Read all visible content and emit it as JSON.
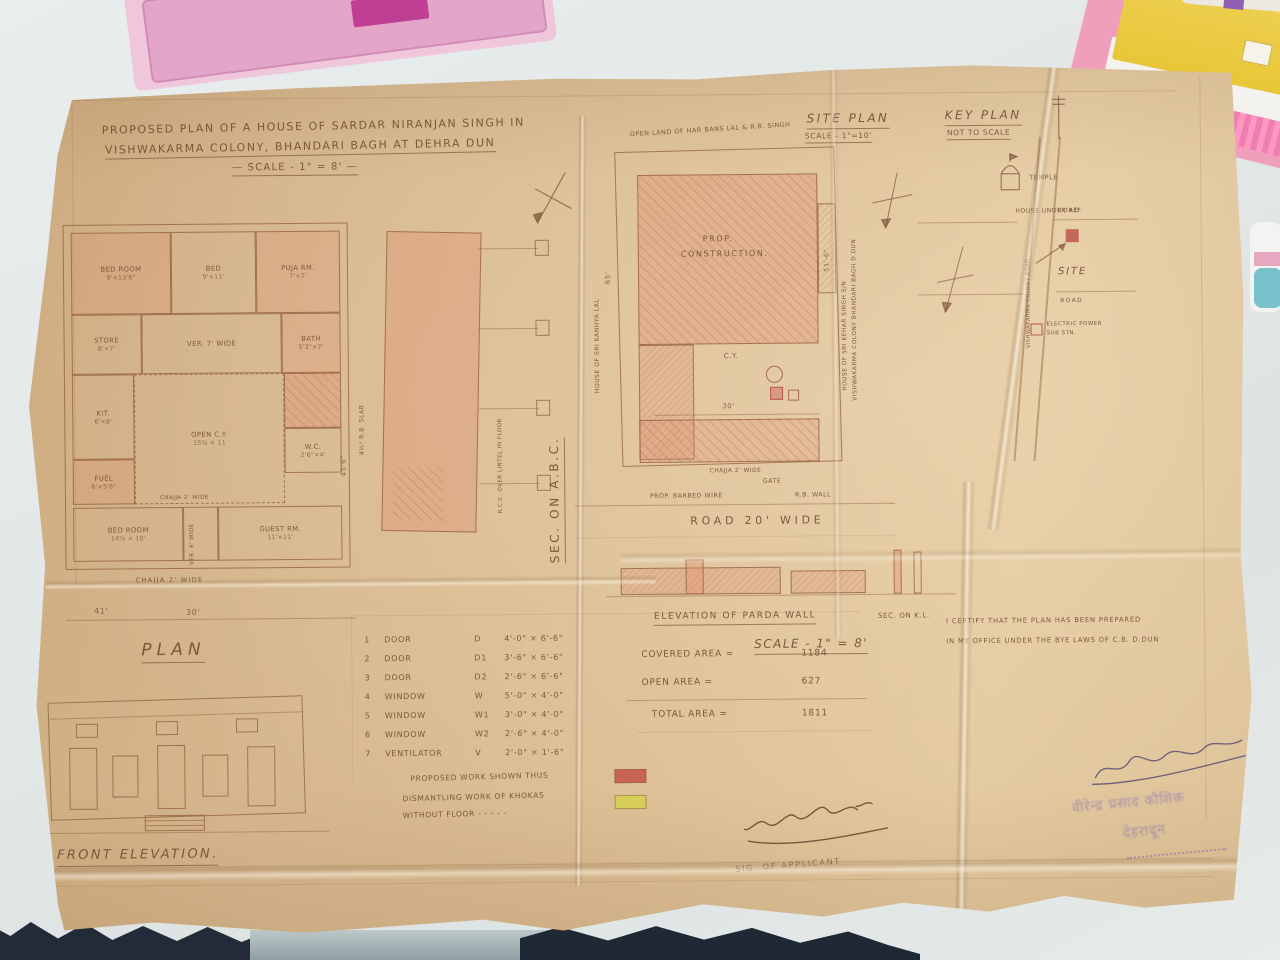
{
  "colors": {
    "paper": "#d9bd96",
    "pencil": "#8a6a4e",
    "pink_wash": "#dd8f70",
    "desk": "#e4e9e9",
    "fabric": "#232b38",
    "stamp": "#7f6cb4",
    "legend_red": "#c4524a",
    "legend_yellow": "#d6ce54",
    "site_marker_red": "#c0564b"
  },
  "title": {
    "l1": "PROPOSED PLAN OF A HOUSE OF SARDAR NIRANJAN SINGH IN",
    "l2": "VISHWAKARMA COLONY, BHANDARI BAGH AT DEHRA DUN",
    "scale": "— SCALE - 1\" = 8' —"
  },
  "floor_plan": {
    "label": "PLAN",
    "chajja_mid": "CHAJJA 2' WIDE",
    "chajja": "CHAJJA 2' WIDE",
    "dim_a": "41'",
    "dim_b": "30'",
    "rooms": [
      {
        "name": "BED ROOM",
        "size": "9'×13'6\""
      },
      {
        "name": "BED",
        "size": "9'×11'"
      },
      {
        "name": "PUJA RM.",
        "size": "7'×7'"
      },
      {
        "name": "STORE",
        "size": "8'×7'"
      },
      {
        "name": "VER. 7' WIDE",
        "size": ""
      },
      {
        "name": "BATH",
        "size": "5'3\"×7'"
      },
      {
        "name": "KIT.",
        "size": "6'×8'"
      },
      {
        "name": "OPEN C.Y.",
        "size": "15⅝ × 11"
      },
      {
        "name": "FUEL",
        "size": "6'×5'6\""
      },
      {
        "name": "W.C.",
        "size": "2'6\"×4'"
      },
      {
        "name": "BED ROOM",
        "size": "14⅝ × 10'"
      },
      {
        "name": "VER. 4' WIDE",
        "size": ""
      },
      {
        "name": "GUEST RM.",
        "size": "11'×11'"
      }
    ]
  },
  "front_elevation": {
    "label": "FRONT ELEVATION."
  },
  "section": {
    "label": "SEC. ON A.B.C.",
    "slab": "4½\" R.B. SLAB",
    "rcc": "R.C.C. OVER LINTEL IN FLOOR",
    "dim": "45'6\""
  },
  "site_plan": {
    "header": "SITE PLAN",
    "scale": "SCALE - 1\"=10'",
    "open_land": "OPEN LAND OF HAR BANS LAL & R.B. SINGH",
    "prop_l1": "PROP.",
    "prop_l2": "CONSTRUCTION.",
    "cy": "C.Y.",
    "dim_mid": "30'",
    "house_left": "HOUSE OF SRI KANHYA LAL",
    "dim_left": "65'",
    "house_right_1": "HOUSE OF SRI KEHAR SINGH S/N",
    "house_right_2": "VISHWAKARMA COLONY BHANDARI BAGH D.DUN",
    "dim_right": "51'-6\"",
    "chajja": "CHAJJA 2' WIDE",
    "gate": "GATE",
    "barbed": "PROP. BARBED WIRE",
    "wall": "R.B. WALL",
    "road": "ROAD 20' WIDE"
  },
  "key_plan": {
    "header": "KEY PLAN",
    "scale": "NOT TO SCALE",
    "temple": "TEMPLE",
    "house_ref": "HOUSE UNDER REF.",
    "road_top": "ROAD",
    "road_bottom": "ROAD",
    "road_side": "VISHWAKARMA COLONY ROAD",
    "site": "SITE",
    "power_l1": "ELECTRIC POWER",
    "power_l2": "SUB STN."
  },
  "parda": {
    "label": "ELEVATION OF PARDA WALL",
    "sec": "SEC. ON K.L.",
    "scale": "SCALE - 1\" = 8'"
  },
  "schedule": {
    "rows": [
      {
        "no": "1",
        "item": "DOOR",
        "sym": "D",
        "size": "4'-0\" × 6'-6\""
      },
      {
        "no": "2",
        "item": "DOOR",
        "sym": "D1",
        "size": "3'-6\" × 6'-6\""
      },
      {
        "no": "3",
        "item": "DOOR",
        "sym": "D2",
        "size": "2'-6\" × 6'-6\""
      },
      {
        "no": "4",
        "item": "WINDOW",
        "sym": "W",
        "size": "5'-0\" × 4'-0\""
      },
      {
        "no": "5",
        "item": "WINDOW",
        "sym": "W1",
        "size": "3'-0\" × 4'-0\""
      },
      {
        "no": "6",
        "item": "WINDOW",
        "sym": "W2",
        "size": "2'-6\" × 4'-0\""
      },
      {
        "no": "7",
        "item": "VENTILATOR",
        "sym": "V",
        "size": "2'-0\" × 1'-6\""
      }
    ]
  },
  "areas": {
    "covered_label": "COVERED AREA =",
    "covered": "1184",
    "open_label": "OPEN AREA =",
    "open": "627",
    "total_label": "TOTAL AREA =",
    "total": "1811"
  },
  "legend": {
    "l1": "PROPOSED WORK SHOWN THUS",
    "l2": "DISMANTLING WORK OF KHOKAS",
    "l3": "WITHOUT FLOOR - - - - -"
  },
  "certificate": {
    "l1": "I CERTIFY THAT THE PLAN HAS BEEN PREPARED",
    "l2": "IN MY OFFICE UNDER THE BYE LAWS OF C.B. D.DUN"
  },
  "signature": {
    "label": "SIG. OF APPLICANT"
  },
  "stamp": {
    "l1": "वीरेन्द्र प्रसाद कौशिक",
    "l2": "देहरादून"
  }
}
